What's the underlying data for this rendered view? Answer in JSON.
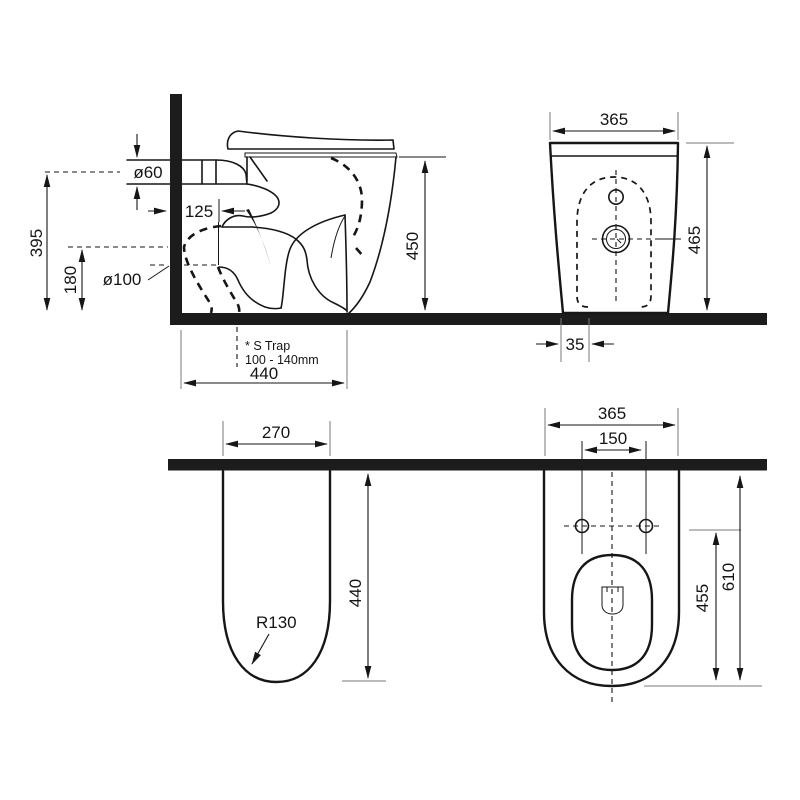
{
  "drawing": {
    "colors": {
      "line": "#161616",
      "extension": "#7a7a7a",
      "background": "#ffffff",
      "solid_fill": "#1c1c1c"
    },
    "side_view": {
      "dims": {
        "inlet_height": "395",
        "outlet_height": "180",
        "inlet_diameter": "ø60",
        "outlet_diameter": "ø100",
        "setout": "125",
        "seat_height": "450",
        "depth": "440"
      },
      "note": {
        "line1": "* S Trap",
        "line2": "100 - 140mm"
      }
    },
    "front_view": {
      "dims": {
        "width": "365",
        "height": "465",
        "offset": "35"
      }
    },
    "plan_profile_view": {
      "dims": {
        "width": "270",
        "depth": "440",
        "radius": "R130"
      }
    },
    "plan_top_view": {
      "dims": {
        "width": "365",
        "bolt_spacing": "150",
        "bowl_depth": "455",
        "overall_depth": "610"
      }
    }
  }
}
